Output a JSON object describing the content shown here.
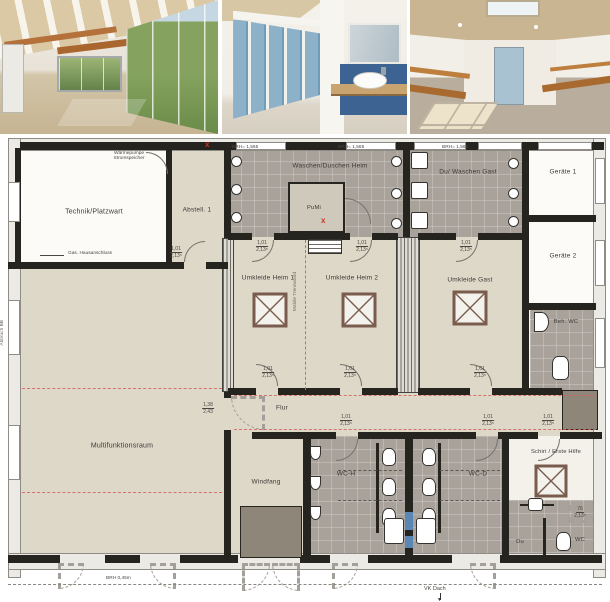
{
  "rooms": {
    "technik": "Technik/Platzwart",
    "abstell": "Abstell. 1",
    "waschen_heim": "Waschen/Duschen Heim",
    "pumi": "PuMi",
    "du_waschen_gast": "Du/ Waschen Gast",
    "geraete1": "Geräte 1",
    "geraete2": "Geräte 2",
    "umkleide_heim1": "Umkleide Heim 1",
    "umkleide_heim2": "Umkleide Heim 2",
    "umkleide_gast": "Umkleide Gast",
    "beh_wc": "Beh. WC",
    "multifunktionsraum": "Multifunktionsraum",
    "flur": "Flur",
    "windfang": "Windfang",
    "wc_h": "WC-H",
    "wc_d": "WC-D",
    "schiri": "Schiri / Erste Hilfe",
    "du": "Du",
    "wc": "WC"
  },
  "annotations": {
    "waermepumpe_1": "Wärmepumpe",
    "waermepumpe_2": "Stromspeicher",
    "gas": "Gas. Hausanschluss",
    "brh_window": "BRH= 1,565",
    "brh_bottom": "BRH 0,45m",
    "vk_dach": "VK Dach",
    "abbruch": "Abbruch BB",
    "mobile_trennwand": "Mobile Trennwand",
    "marker_x": "x"
  },
  "doors": {
    "standard_w": "1,01",
    "standard_h": "2,13⁵",
    "wide_w": "1,38",
    "wide_h": "2,43",
    "narrow_w": "76",
    "narrow_h": "2,13⁵"
  },
  "colors": {
    "room_beige": "#ded8c9",
    "wet_gray": "#a9a29b",
    "wall_dark": "#26241f",
    "mat_gray": "#8d8679",
    "accent_red": "#c0392b",
    "glass_blue": "#5b87b5"
  },
  "photos": {
    "p1": "multifunction-room-render",
    "p2": "washroom-render",
    "p3": "changing-room-render"
  }
}
